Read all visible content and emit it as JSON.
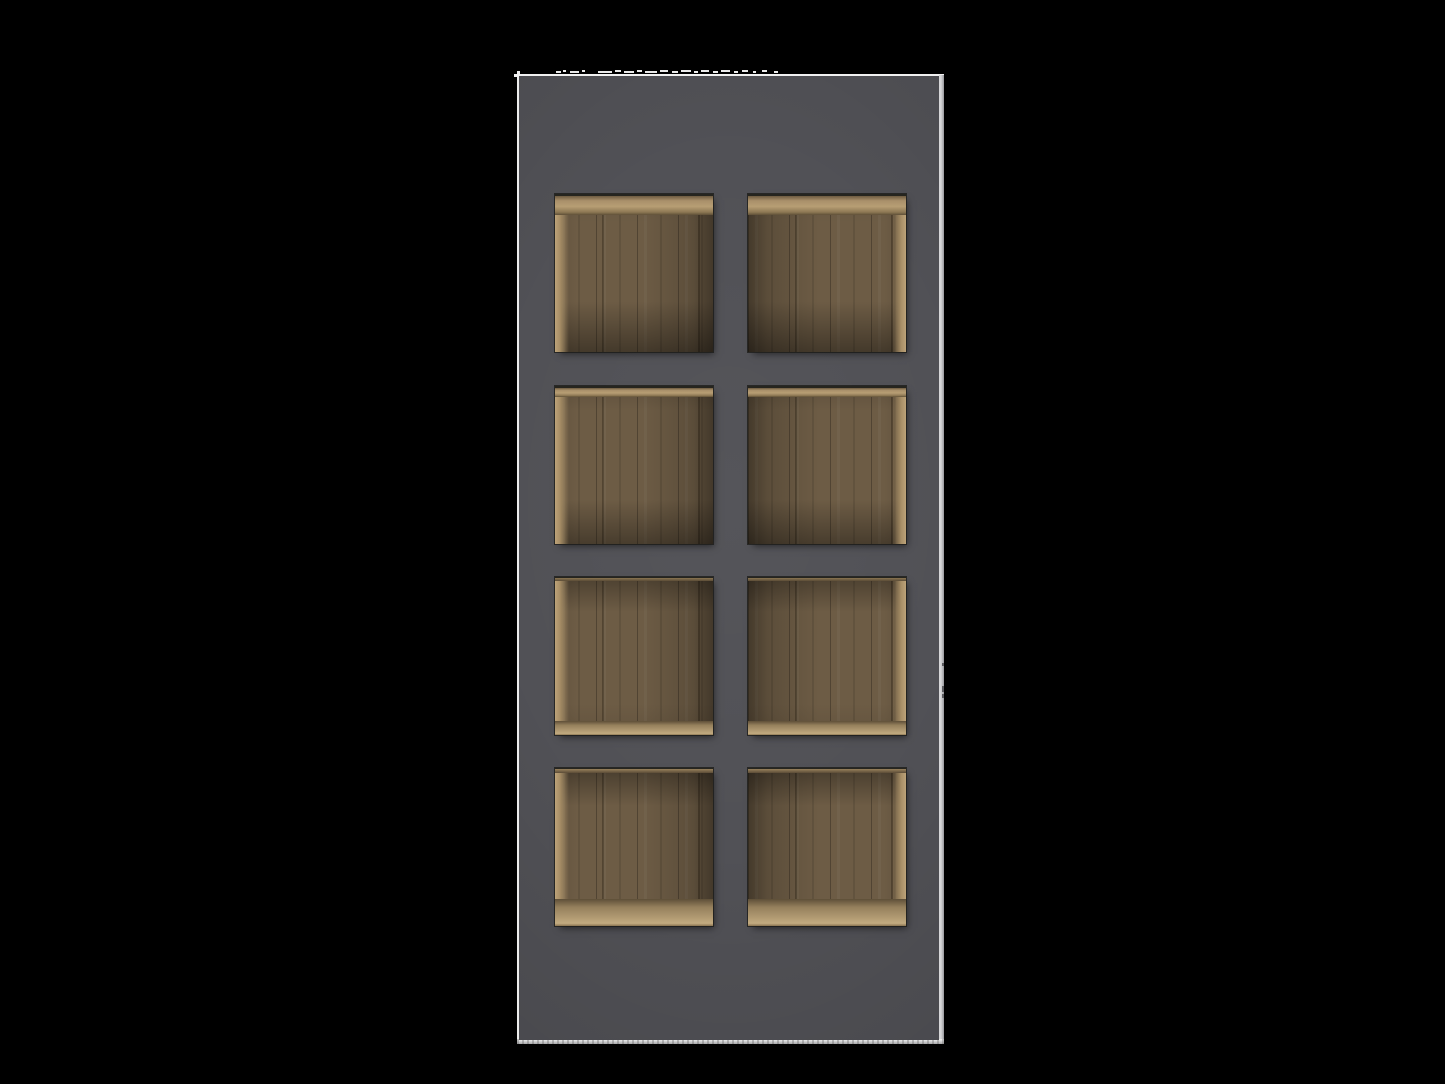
{
  "scene": {
    "type": "3d-product-render",
    "subject": "dark gray cabinet with eight open wooden cubby compartments on black background",
    "background_color": "#000000",
    "cabinet": {
      "front_color": "#515156",
      "top_edge_highlight": "#f1f1f1",
      "left_edge_highlight": "#ececec",
      "right_edge_color": "#98989c",
      "bottom_edge_color": "#a9a9ab",
      "compartment_count": 8
    },
    "cubbies": {
      "rows": 4,
      "cols": 2,
      "cell_width": 158,
      "cell_height": 158,
      "row_tops": [
        194,
        386,
        577,
        768
      ],
      "col_lefts": [
        555,
        748
      ],
      "wood_mid_color": "#6b5a43",
      "wood_light_color": "#b79e74",
      "wood_dark_color": "#5b4c37"
    },
    "artifacts": {
      "dash_color": "#e9e9e9",
      "tick_color": "#5a5a5e",
      "top_dashes": [
        [
          556,
          71,
          5
        ],
        [
          563,
          70,
          3
        ],
        [
          570,
          71,
          9
        ],
        [
          582,
          70,
          3
        ],
        [
          598,
          71,
          14
        ],
        [
          615,
          70,
          6
        ],
        [
          624,
          71,
          10
        ],
        [
          637,
          70,
          5
        ],
        [
          645,
          71,
          12
        ],
        [
          660,
          70,
          8
        ],
        [
          672,
          71,
          6
        ],
        [
          681,
          70,
          10
        ],
        [
          694,
          71,
          4
        ],
        [
          701,
          70,
          8
        ],
        [
          713,
          71,
          5
        ],
        [
          721,
          70,
          9
        ],
        [
          734,
          71,
          4
        ],
        [
          742,
          70,
          6
        ],
        [
          753,
          71,
          3
        ],
        [
          762,
          70,
          5
        ],
        [
          774,
          71,
          4
        ]
      ],
      "right_ticks": [
        [
          942,
          663,
          2,
          3
        ],
        [
          942,
          686,
          2,
          6
        ],
        [
          942,
          694,
          2,
          4
        ]
      ]
    }
  }
}
